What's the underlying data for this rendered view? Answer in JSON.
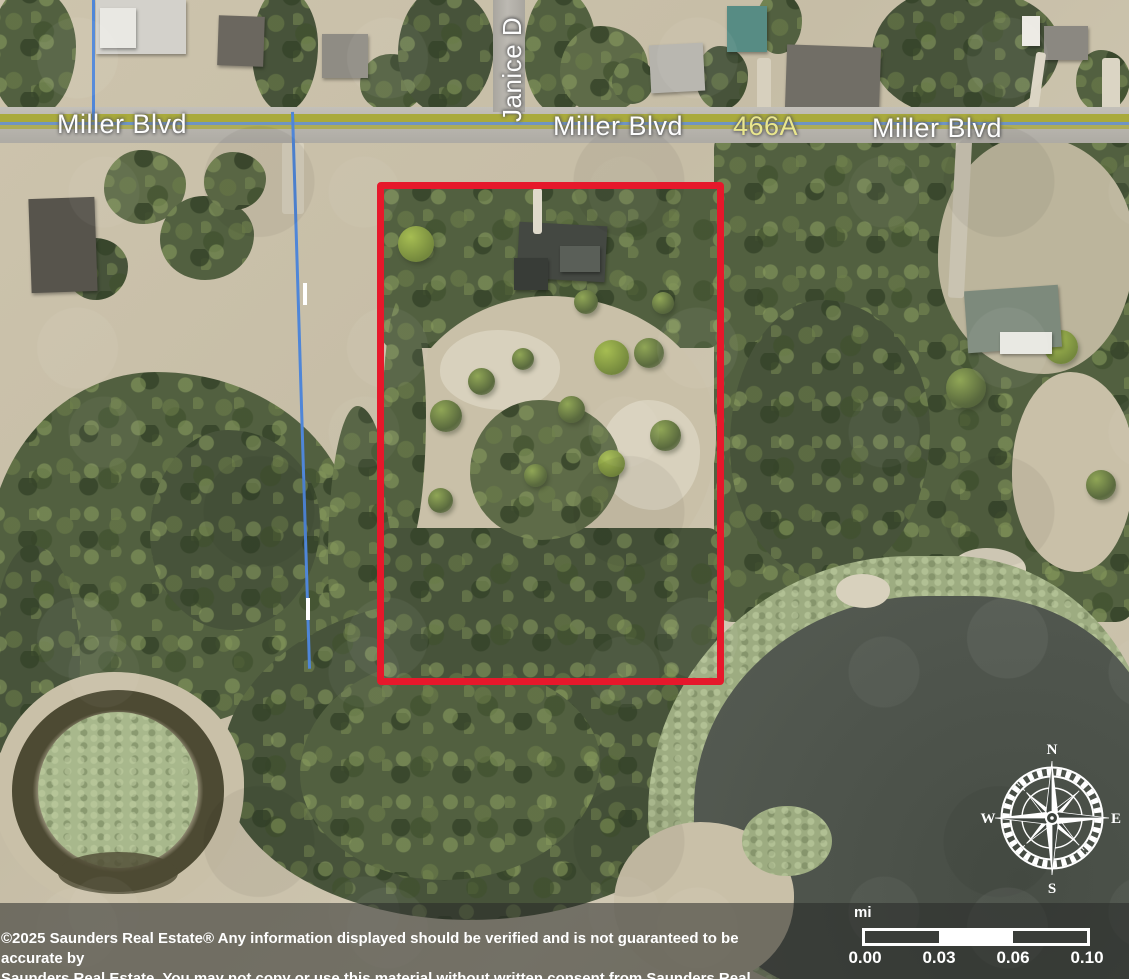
{
  "map": {
    "labels": {
      "miller_blvd_west": "Miller Blvd",
      "miller_blvd_center": "Miller Blvd",
      "route_466a": "466A",
      "miller_blvd_east": "Miller Blvd",
      "janice_dr": "Janice D"
    },
    "colors": {
      "parcel_outline": "#e6182b",
      "parcel_line_blue": "#4f86d8",
      "road_stripe_olive": "#a9aa3c",
      "road_label_white": "#fdfdfd",
      "route_label_yellow": "#e9e68d",
      "lake_water": "#4f554d",
      "pond_vegetation": "#a8b88c"
    }
  },
  "compass": {
    "north": "N",
    "east": "E",
    "south": "S",
    "west": "W"
  },
  "scale_bar": {
    "unit": "mi",
    "ticks": [
      "0.00",
      "0.03",
      "0.06",
      "0.10"
    ]
  },
  "footer": {
    "line1": "©2025 Saunders Real Estate® Any information displayed should be verified and is not guaranteed to be accurate by",
    "line2": "Saunders Real Estate. You may not copy or use this material without written consent from Saunders Real Estate."
  }
}
